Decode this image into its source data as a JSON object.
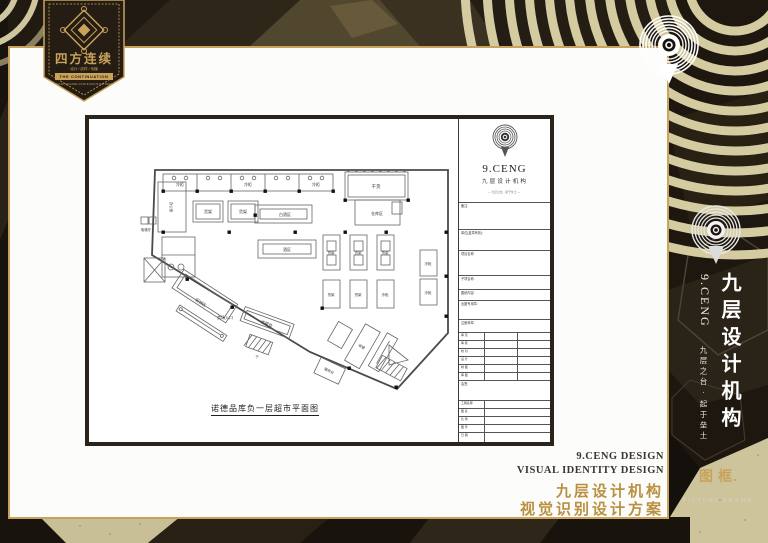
{
  "colors": {
    "gold": "#c9a35c",
    "gold_deep": "#b9903f",
    "dark": "#18130e",
    "sand": "#d2c9a2",
    "ink": "#2b231c"
  },
  "badge": {
    "title": "四方连续",
    "subtitle": "· 设计 / 纹样 / 传播 ·",
    "bar": "THE CONTINUATION",
    "footnote": "FOUR-SQUARE CONTINUOUS PATTERN"
  },
  "sidebar": {
    "brand_cn": "九层设计机构",
    "brand_en": "9.CENG",
    "motto": "九层之台·起于垒土",
    "section_cn": "图框",
    "section_en": "PICTURE FRAME"
  },
  "footer": {
    "en1": "9.CENG DESIGN",
    "en2": "VISUAL IDENTITY DESIGN",
    "cn1": "九层设计机构",
    "cn2": "视觉识别设计方案"
  },
  "titleblock": {
    "brand_en": "9.CENG",
    "brand_cn": "九层设计机构",
    "tagline": "— 九层之台 · 起于垒土 —",
    "note": "备注:",
    "fields": [
      "单位(盖章有效):",
      "项目名称:",
      "子项名称:",
      "图纸内容:",
      "出图专用章:",
      "注册师章:"
    ],
    "personnel": [
      "审 定",
      "审 核",
      "校 对",
      "设 计",
      "制 图",
      "审 图"
    ],
    "sign": "会签:",
    "info": [
      "工程名称",
      "图 名",
      "比 例",
      "图 号",
      "日 期"
    ]
  },
  "plan": {
    "caption": "诺德品库负一层超市平面图",
    "labels": {
      "cooler": "冷柜",
      "shelf": "货架",
      "dry": "干货",
      "store": "仓库区",
      "office": "办公室",
      "lift": "电梯厅",
      "wine": "白酒区",
      "drink": "酒区",
      "promo": "促销区",
      "entrance": "卖场入口",
      "cashier": "收银台",
      "cash": "收银",
      "service": "服务台",
      "down": "下"
    }
  }
}
